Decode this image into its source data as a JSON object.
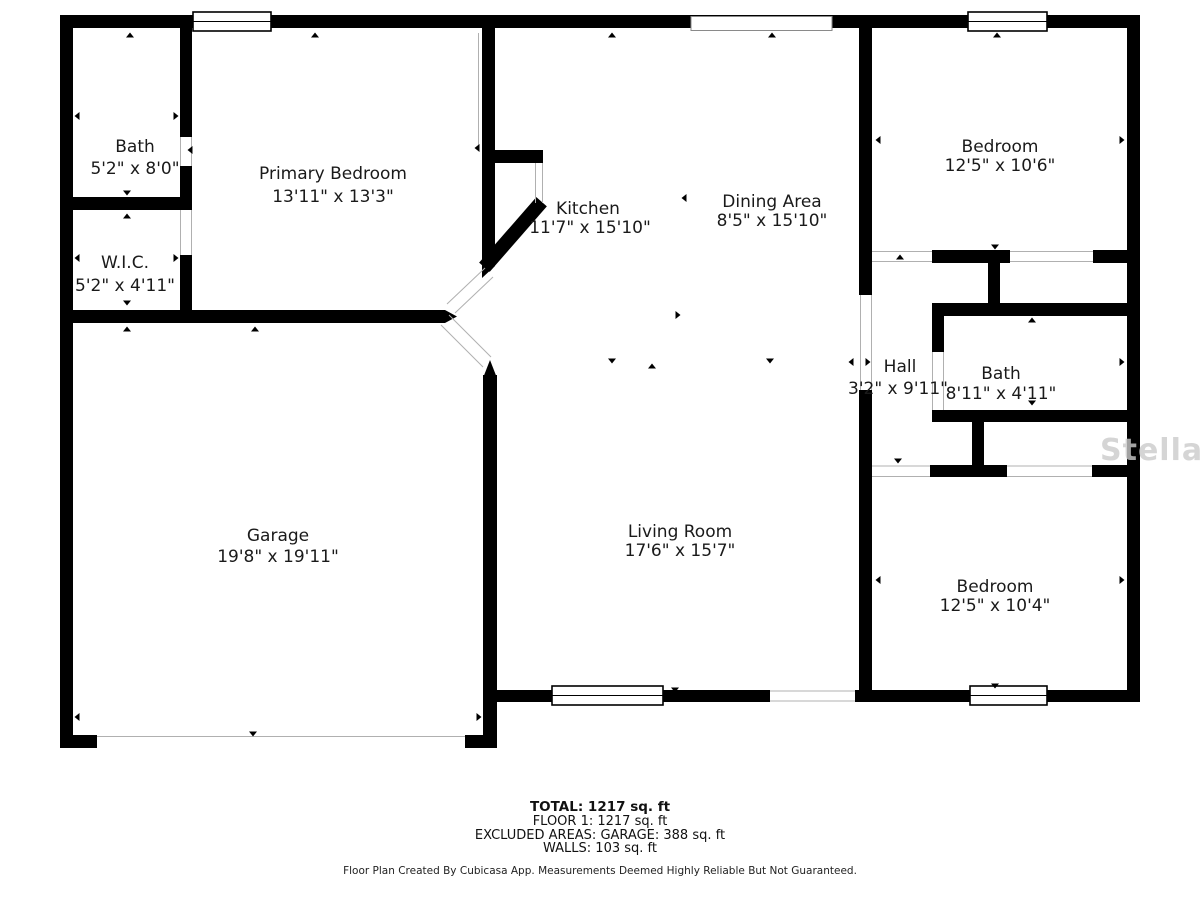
{
  "plan": {
    "rooms": [
      {
        "id": "bath-upper-left",
        "name": "Bath",
        "dims": "5'2\" x 8'0\""
      },
      {
        "id": "primary-bedroom",
        "name": "Primary Bedroom",
        "dims": "13'11\" x 13'3\""
      },
      {
        "id": "wic",
        "name": "W.I.C.",
        "dims": "5'2\" x 4'11\""
      },
      {
        "id": "kitchen",
        "name": "Kitchen",
        "dims": "11'7\" x 15'10\""
      },
      {
        "id": "dining-area",
        "name": "Dining Area",
        "dims": "8'5\" x 15'10\""
      },
      {
        "id": "bedroom-top-right",
        "name": "Bedroom",
        "dims": "12'5\" x 10'6\""
      },
      {
        "id": "hall",
        "name": "Hall",
        "dims": "3'2\" x 9'11\""
      },
      {
        "id": "bath-right",
        "name": "Bath",
        "dims": "8'11\" x 4'11\""
      },
      {
        "id": "garage",
        "name": "Garage",
        "dims": "19'8\" x 19'11\""
      },
      {
        "id": "living-room",
        "name": "Living Room",
        "dims": "17'6\" x 15'7\""
      },
      {
        "id": "bedroom-bottom-right",
        "name": "Bedroom",
        "dims": "12'5\" x 10'4\""
      }
    ]
  },
  "summary": {
    "total": "TOTAL: 1217 sq. ft",
    "floor1": "FLOOR 1: 1217 sq. ft",
    "excluded": "EXCLUDED AREAS: GARAGE: 388 sq. ft",
    "walls": "WALLS: 103 sq. ft"
  },
  "disclaimer": "Floor Plan Created By Cubicasa App. Measurements Deemed Highly Reliable But Not Guaranteed.",
  "watermark": "StellarMLS",
  "colors": {
    "wall": "#000000",
    "opening_line": "#b0b0b0",
    "text": "#1a1a1a",
    "watermark": "#cbcbcb"
  }
}
